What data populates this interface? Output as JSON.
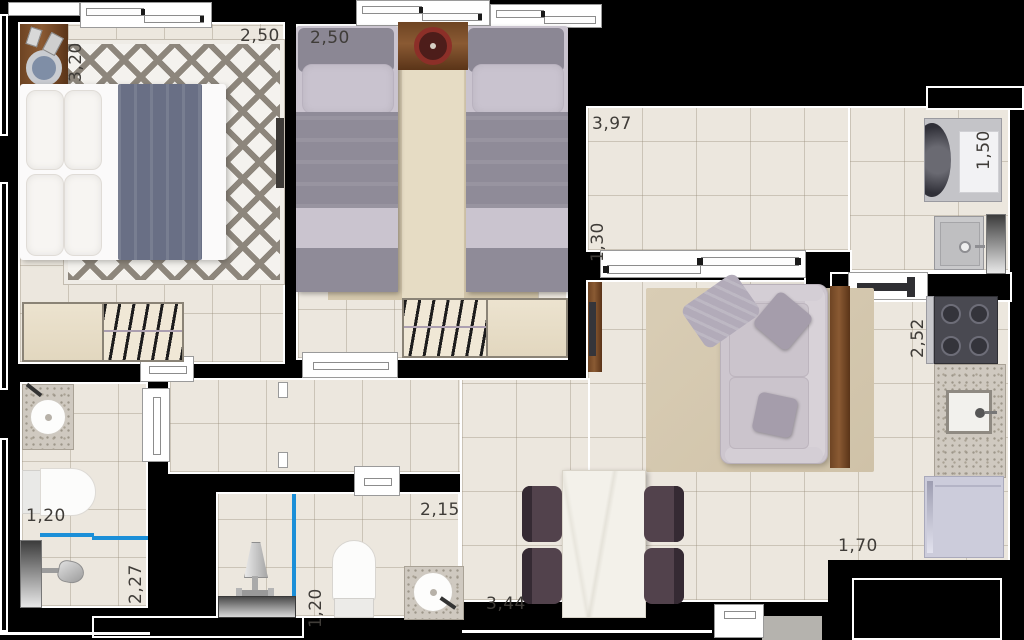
{
  "plan_type": "apartment-floor-plan",
  "unit": "meters",
  "colors": {
    "wall": "#000000",
    "floor": "#ece7de",
    "accent-blue": "#1b8fd8",
    "wood": "#7a4c28",
    "granite": "#cfc9c0"
  },
  "labels": {
    "bedroom1_depth": "3,20",
    "bedroom1_width": "2,50",
    "bedroom2_width": "2,50",
    "balcony_width": "3,97",
    "balcony_depth": "1,30",
    "laundry_width": "1,50",
    "kitchen_depth": "2,52",
    "kitchen_width": "1,70",
    "bath1_width": "1,20",
    "bath1_depth": "2,27",
    "bath2_width": "2,15",
    "bath2_depth": "1,20",
    "dining_width": "3,44"
  }
}
